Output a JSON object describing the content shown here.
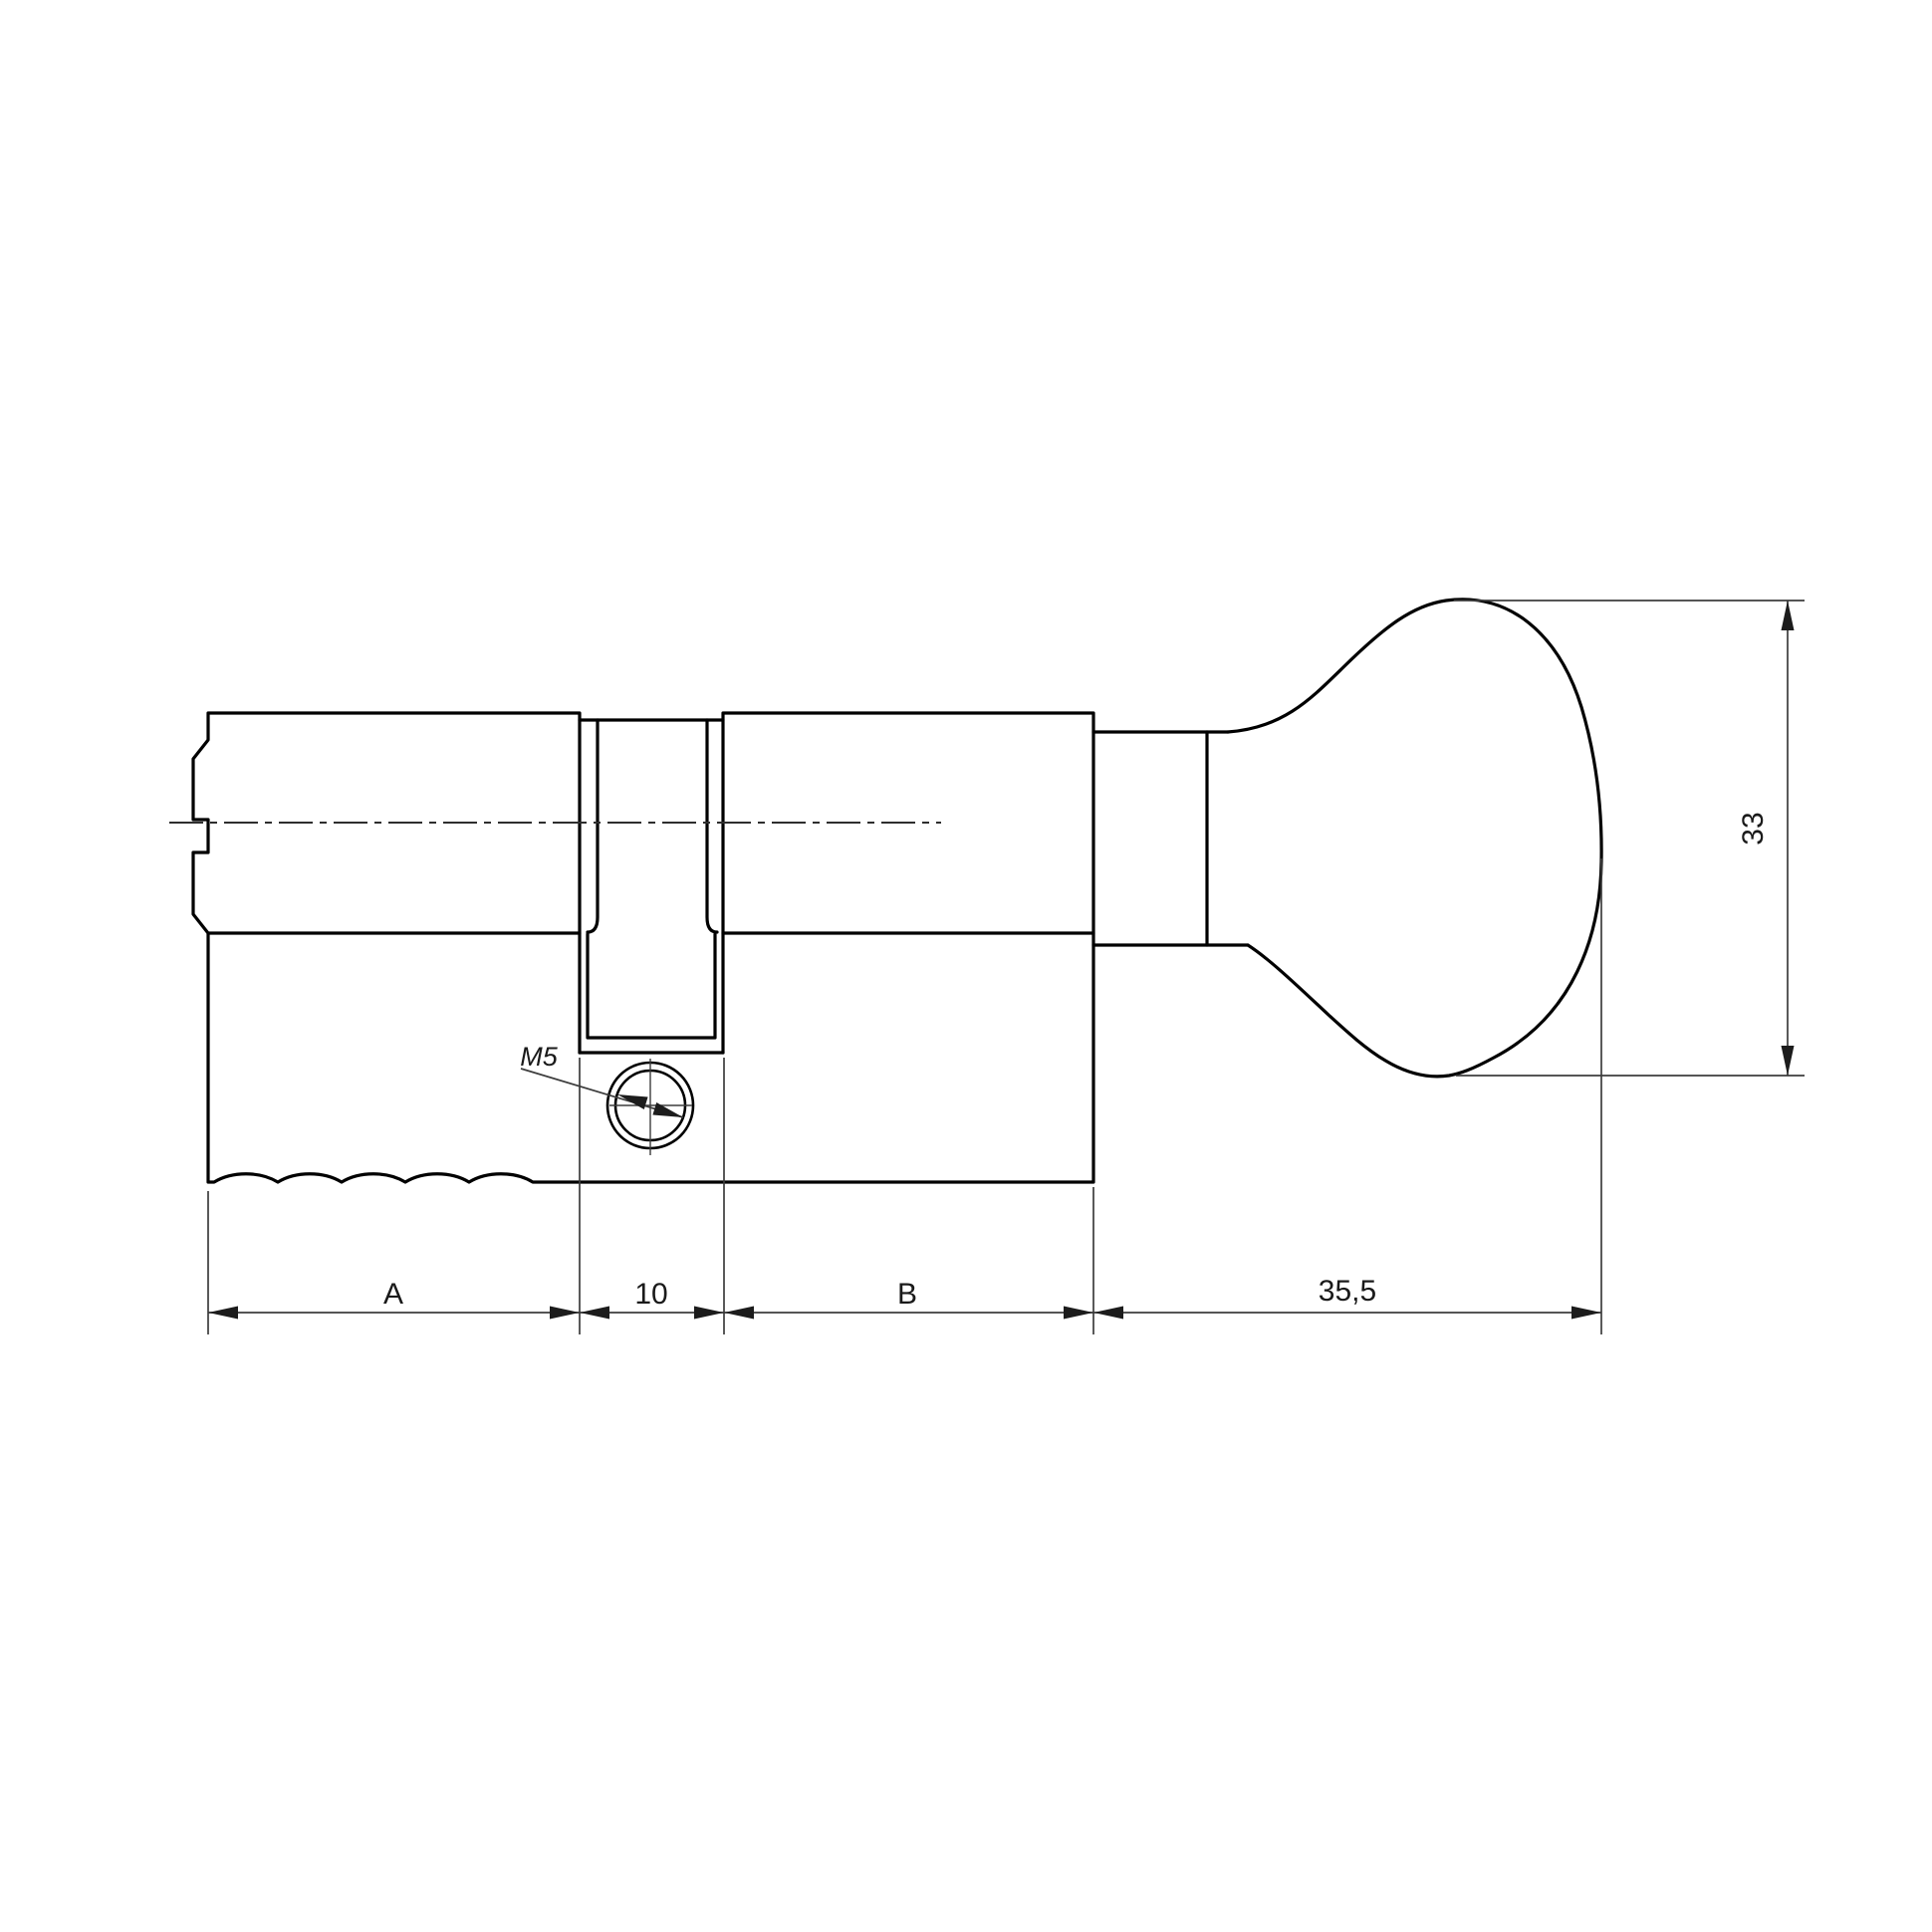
{
  "page": {
    "background": "#ffffff"
  },
  "drawing": {
    "kind": "Dimensioned engineering drawing of a profile lock cylinder with thumb-turn knob",
    "annotations": {
      "dim_a": "A",
      "dim_mid": "10",
      "dim_b": "B",
      "dim_knob_length": "35,5",
      "dim_knob_diameter": "33",
      "thread_callout": "M5"
    },
    "colors": {
      "outline": "#000000",
      "dimension": "#3d3d3d",
      "text": "#1a1a1a",
      "background": "#ffffff"
    }
  }
}
